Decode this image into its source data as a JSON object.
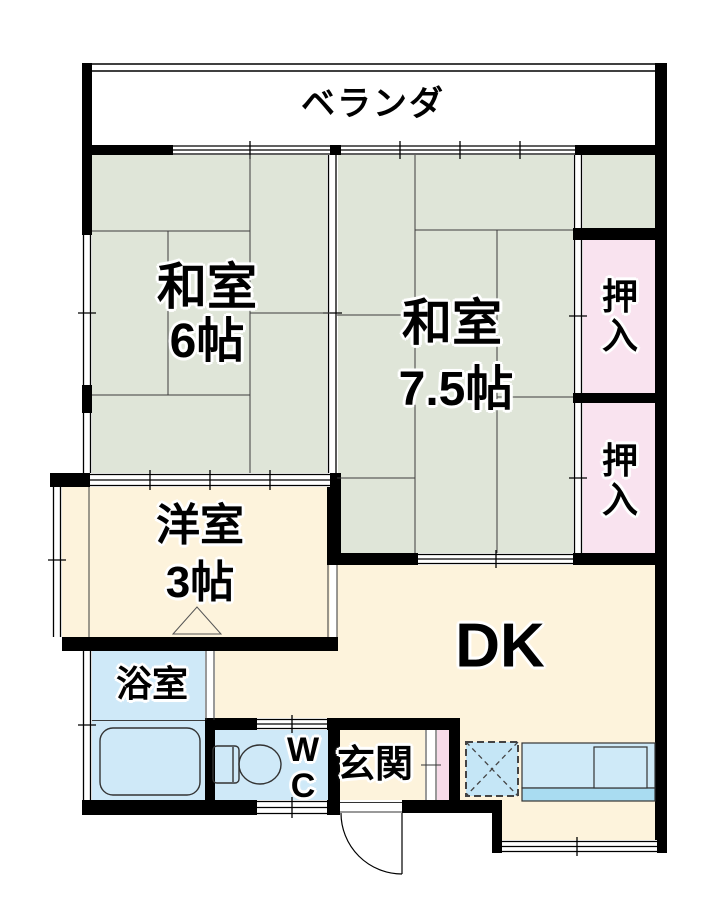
{
  "title": "間取り図",
  "colors": {
    "wall": "#000000",
    "tatami_green": "#dfe5d8",
    "closet_pink": "#f9e3ef",
    "flooring_cream": "#fdf3dc",
    "bath_blue": "#cfe9f8",
    "counter_blue": "#cfeaf8",
    "counter_edge_blue": "#a9dcf1",
    "fridge_blue": "#c5e6f6",
    "entry_pink": "#f7dbe9",
    "line": "#3c3c3c"
  },
  "rooms": {
    "veranda": {
      "label": "ベランダ"
    },
    "washitsu6": {
      "line1": "和室",
      "line2": "6帖"
    },
    "washitsu75": {
      "line1": "和室",
      "line2": "7.5帖"
    },
    "oshiire1": {
      "label": "押入"
    },
    "oshiire2": {
      "label": "押入"
    },
    "youshitsu": {
      "line1": "洋室",
      "line2": "3帖"
    },
    "dk": {
      "label": "DK"
    },
    "bath": {
      "label": "浴室"
    },
    "wc": {
      "line1": "W",
      "line2": "C"
    },
    "genkan": {
      "label": "玄関"
    }
  }
}
